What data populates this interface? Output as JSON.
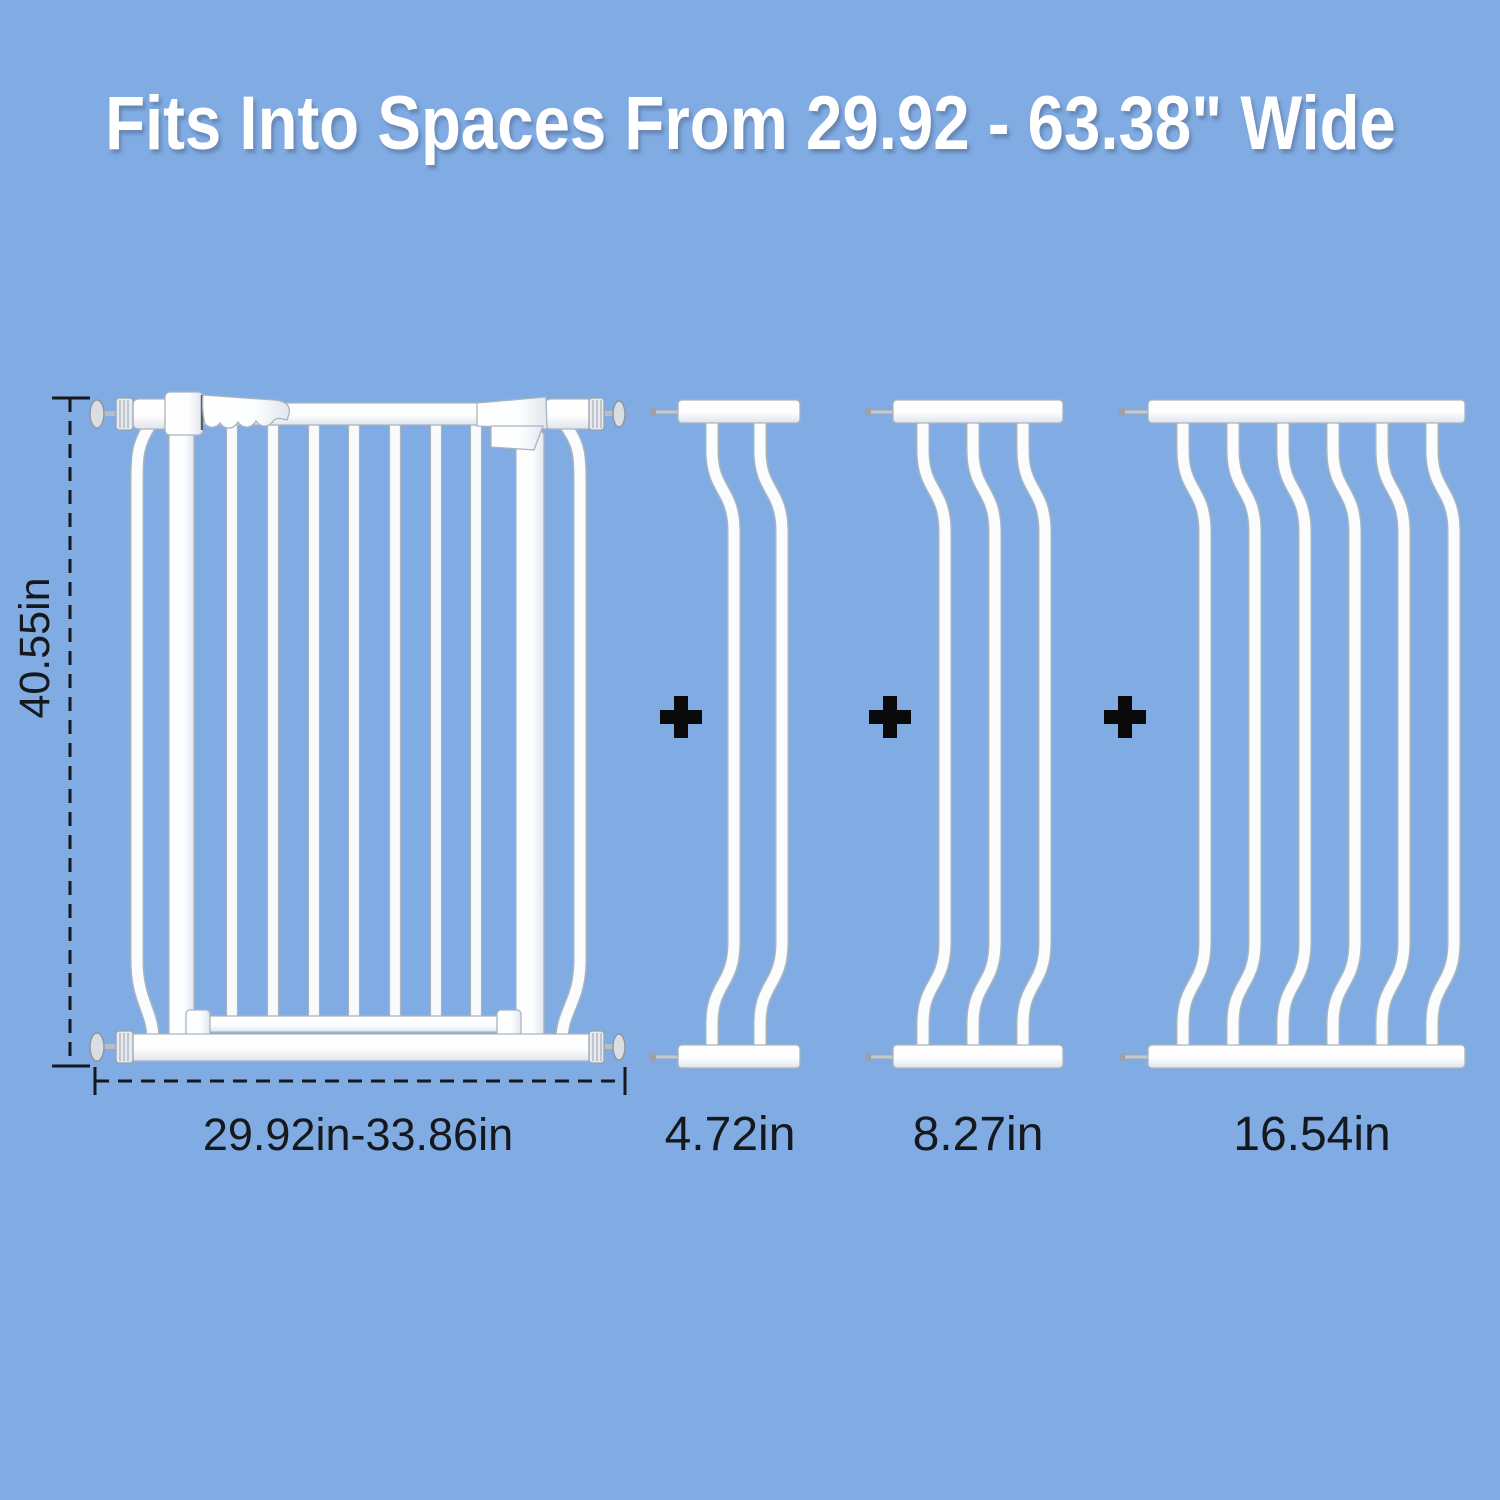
{
  "title": "Fits Into Spaces From 29.92 - 63.38\" Wide",
  "colors": {
    "background": "#80ACE3",
    "title_text": "#FFFFFF",
    "annotation_text": "#15181C",
    "gate_white": "#FAFCFD",
    "plus_black": "#0A0A0A"
  },
  "main_gate": {
    "height_label": "40.55in",
    "width_label": "29.92in-33.86in"
  },
  "extensions": [
    {
      "label": "4.72in"
    },
    {
      "label": "8.27in"
    },
    {
      "label": "16.54in"
    }
  ]
}
